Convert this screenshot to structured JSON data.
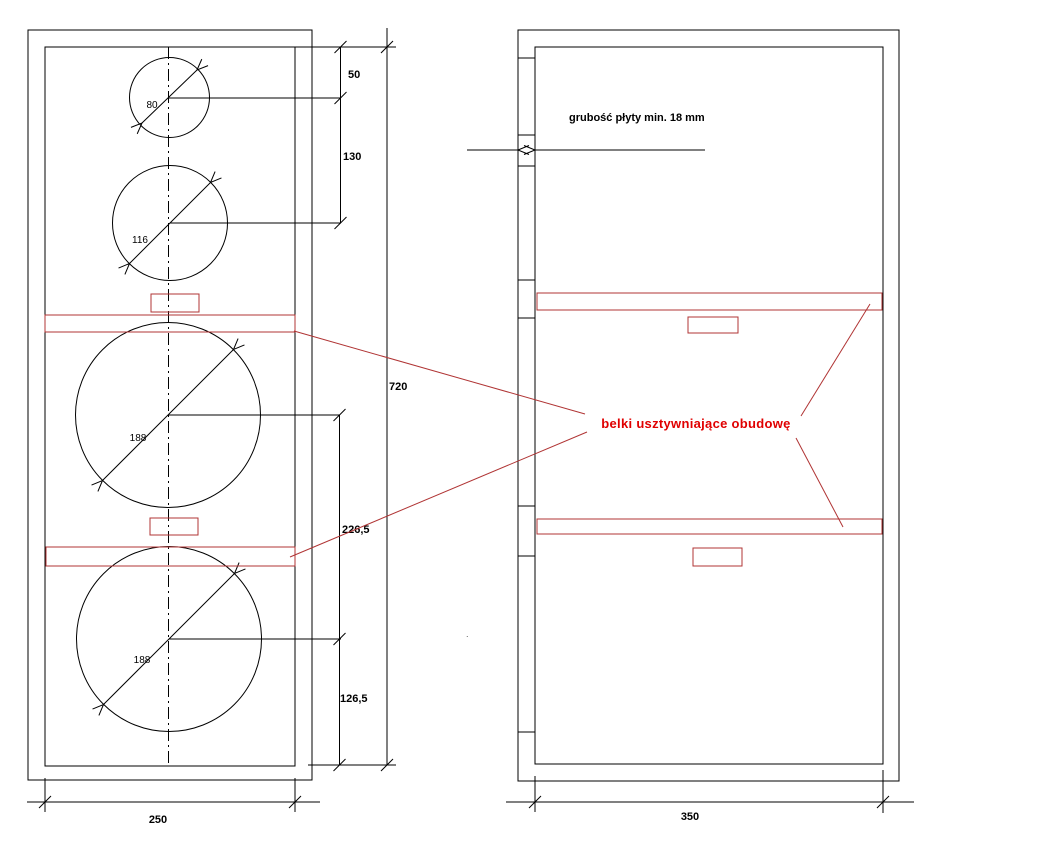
{
  "front_view": {
    "drivers": [
      {
        "diameter_label": "80"
      },
      {
        "diameter_label": "116"
      },
      {
        "diameter_label": "188"
      },
      {
        "diameter_label": "188"
      }
    ],
    "dimensions": {
      "top_offset": "50",
      "tweeter_to_midrange": "130",
      "height": "720",
      "woofer_spacing": "226,5",
      "bottom_offset": "126,5",
      "width": "250"
    }
  },
  "side_view": {
    "dimensions": {
      "width": "350"
    },
    "plate_thickness_note": "grubość płyty min. 18 mm"
  },
  "annotations": {
    "braces_label": "belki usztywniające obudowę",
    "stray_mark": "."
  },
  "colors": {
    "line": "#000000",
    "red_accent": "#b03434",
    "red_text": "#e00000",
    "background": "#ffffff"
  }
}
